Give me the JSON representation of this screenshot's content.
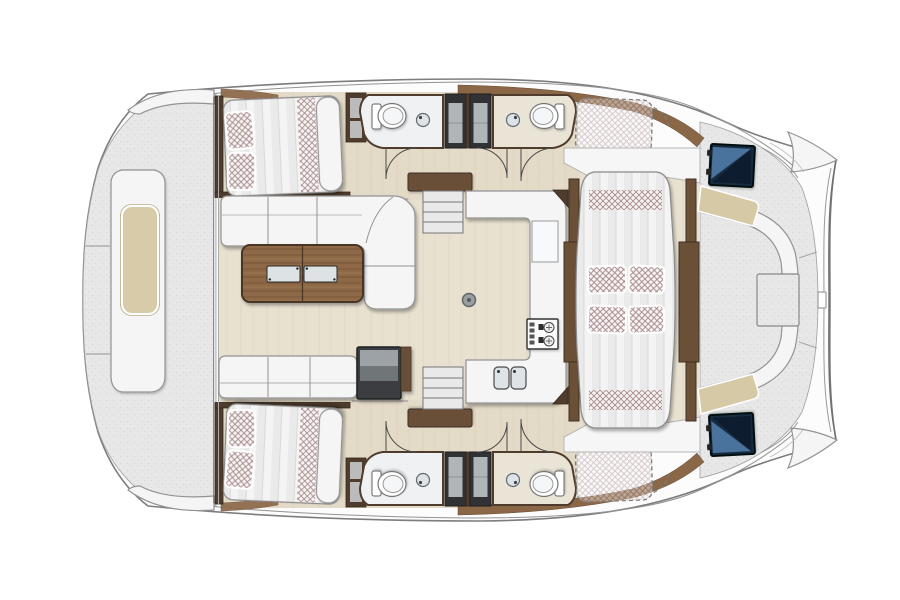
{
  "page": {
    "background": "#ffffff"
  },
  "diagram": {
    "type": "yacht-floor-plan",
    "subject": "catamaran top view, bow left / stern right",
    "components": [
      "foredeck with lounge platform and beige sun pad",
      "starboard forward cabin with double berth and two checkered pillows",
      "port forward cabin with double berth and two checkered pillows",
      "starboard head with toilet and round sink",
      "port head with toilet and round sink",
      "back-to-back wardrobe blocks between heads",
      "salon with L-shaped sofa and wooden coffee table with two glass inserts",
      "port settee bench and dark cabinet",
      "galley with U-counter, two-burner stove, double sink and floor hatch",
      "companionway stairs to each hull",
      "central athwart daybed with four checkered pillows",
      "aft cockpit with C-shaped seating and square table",
      "two navy glass hatches at cockpit corners",
      "dashed checkered sun pads on aft side decks",
      "curved transom with boarding notch"
    ]
  },
  "colors": {
    "background": "#ffffff",
    "hull_outline": "#7d7d7d",
    "hull_fill": "#fcfcfd",
    "deck": "#e7e7e8",
    "floor_wood": "#e8e1d0",
    "floor_grain": "#d8cfba",
    "hull_floor_tint": "#cbb89a",
    "wall_dark": "#503c2c",
    "wall_wood": "#6b5038",
    "coaming": "#8a6747",
    "furniture_white": "#f5f5f6",
    "furniture_line": "#939393",
    "cushion_beige": "#d6c9a6",
    "pad_beige": "#d8cba9",
    "table_wood": "#8d6947",
    "table_wood_dark": "#4a3526",
    "glass": "#dde2e4",
    "checker_line": "#a18484",
    "checker_bg": "#f7f4f3",
    "duvet_light": "#f4f4f4",
    "duvet_dark": "#e2e2e2",
    "cabinet_dark": "#3a3d40",
    "cabinet_inner": "#9da2a6",
    "dark_block": "#303234",
    "block_inset": "#bfc3c6",
    "hatch_navy": "#15293f",
    "hatch_blue": "#527fae",
    "bath_floor": "#eff1f2",
    "bath_floor_warm": "#eae4d6",
    "sink_gray": "#dde3e6",
    "stove_face": "#fbfbfc"
  }
}
